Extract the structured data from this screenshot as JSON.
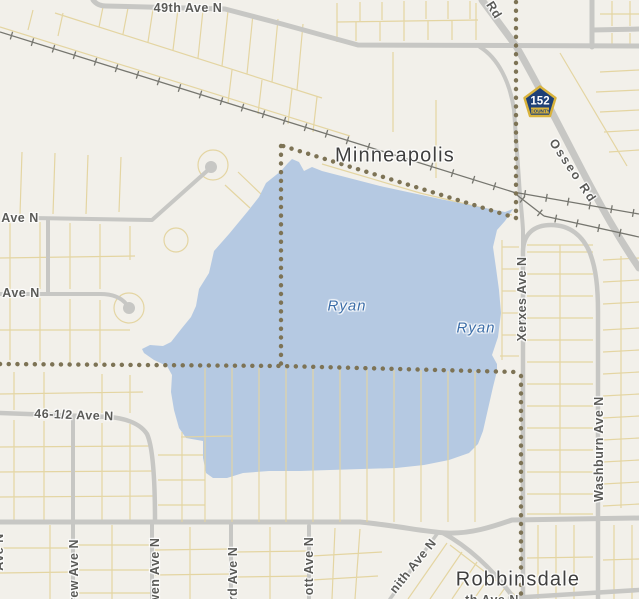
{
  "map": {
    "city_labels": {
      "minneapolis": "Minneapolis",
      "robbinsdale": "Robbinsdale"
    },
    "lake_labels": {
      "ryan_west": "Ryan",
      "ryan_east": "Ryan"
    },
    "streets": {
      "s49th": "49th Ave N",
      "ave_n_upper": "Ave N",
      "ave_n_lower": "Ave N",
      "s46half": "46-1/2 Ave N",
      "xerxes": "Xerxes Ave N",
      "washburn": "Washburn Ave N",
      "osseo": "Osseo Rd",
      "osseo_frag": "Rd",
      "drew_frag": "rew Ave N",
      "chowen_frag": "wen Ave N",
      "beard_frag": "rd Ave N",
      "abbott_frag": "ott Ave N",
      "zenith_frag": "nith Ave N",
      "ewing_frag": "Ave N",
      "bottom_frag": "th Ave N"
    },
    "shield": {
      "route": "152",
      "banner": "COUNTY"
    },
    "colors": {
      "water": "#b5c9e2",
      "land": "#f2f0ea",
      "road": "#c7c7c4",
      "parcel": "#e4d5a2",
      "boundary": "#7d7355",
      "rail": "#76766f",
      "shield_fill": "#1e4076",
      "shield_border": "#d9b33c",
      "street_label": "#5a5a57",
      "city_label": "#3f3f3f",
      "water_label": "#3b6da8"
    }
  }
}
